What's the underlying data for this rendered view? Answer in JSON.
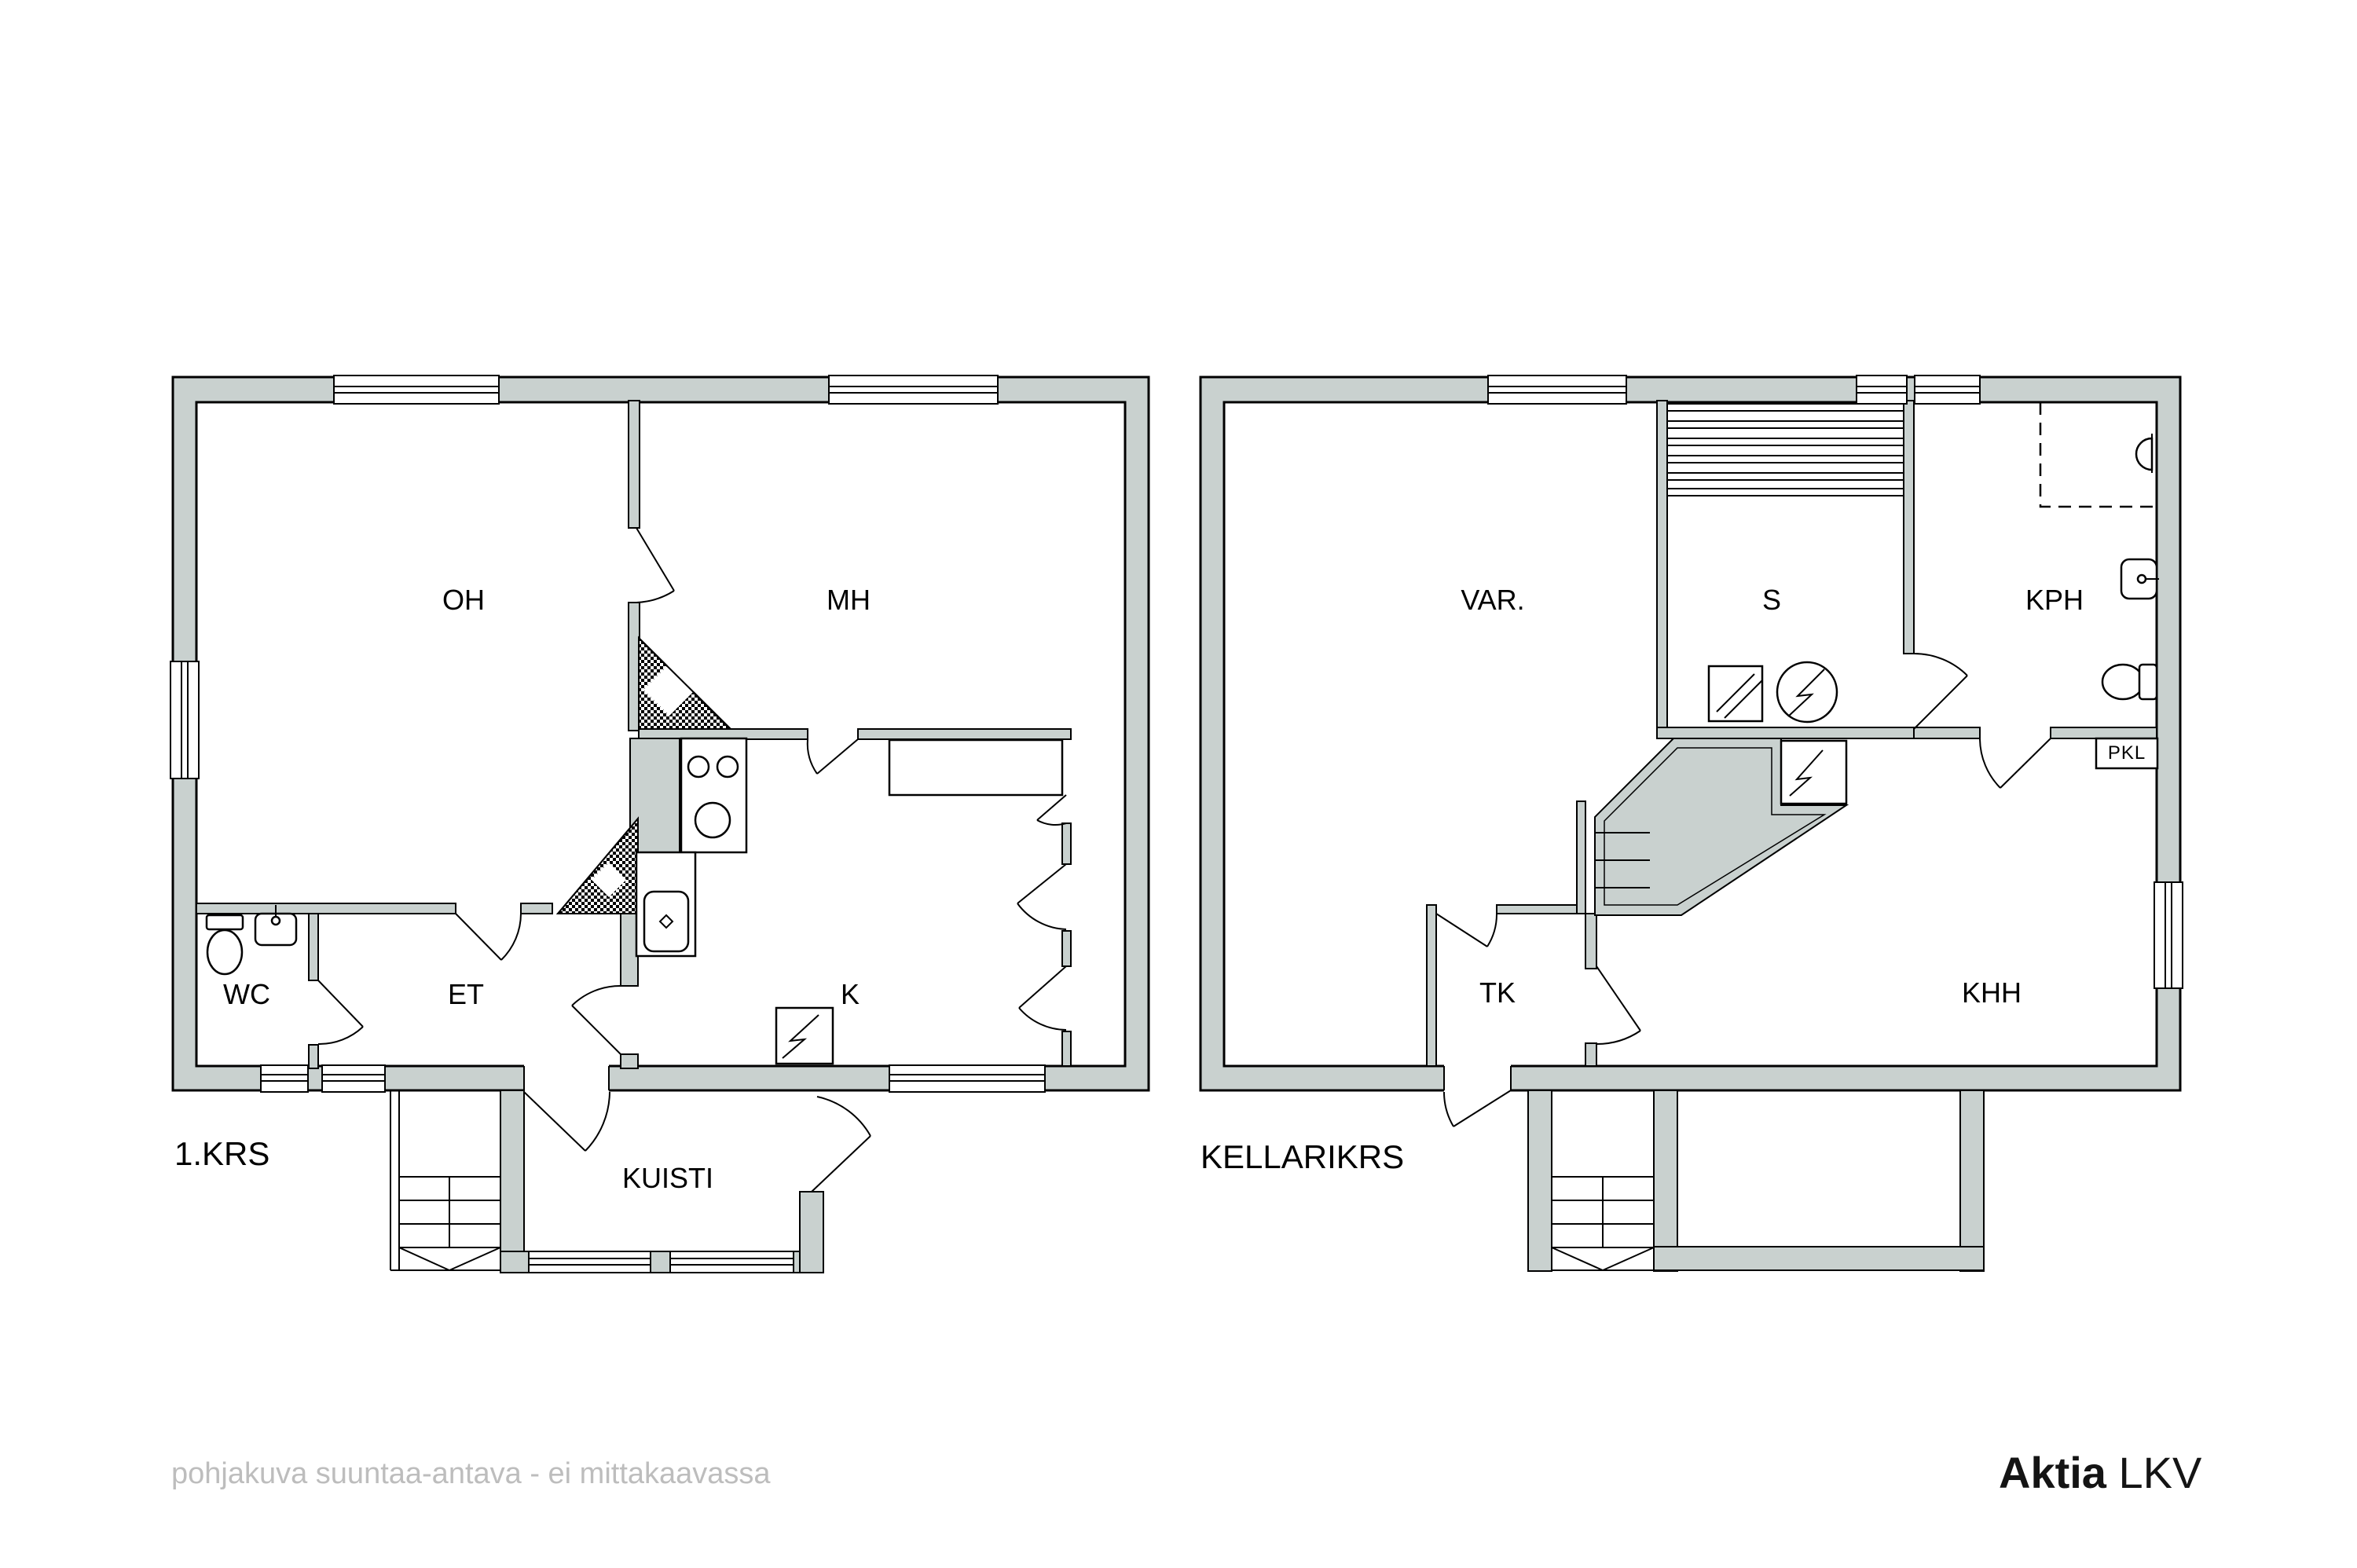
{
  "colors": {
    "wall_fill": "#c9d1cf",
    "line": "#000000",
    "muted_text": "#bdbdbd",
    "brand_text": "#141414",
    "background": "#ffffff"
  },
  "floor1": {
    "name": "1.KRS",
    "rooms": {
      "oh": "OH",
      "mh": "MH",
      "wc": "WC",
      "et": "ET",
      "k": "K",
      "kuisti": "KUISTI"
    }
  },
  "floor2": {
    "name": "KELLARIKRS",
    "rooms": {
      "var": "VAR.",
      "s": "S",
      "kph": "KPH",
      "tk": "TK",
      "khh": "KHH"
    },
    "pkl": "PKL"
  },
  "footer": {
    "disclaimer": "pohjakuva suuntaa-antava - ei mittakaavassa"
  },
  "brand": {
    "name": "Aktia",
    "suffix": " LKV"
  },
  "icons": [
    "toilet-icon",
    "washbasin-icon",
    "stove-icon",
    "kitchen-sink-icon",
    "electrical-panel-icon",
    "sauna-heater-icon",
    "sauna-window-icon",
    "shower-icon",
    "stairs-icon",
    "chimney-icon"
  ]
}
